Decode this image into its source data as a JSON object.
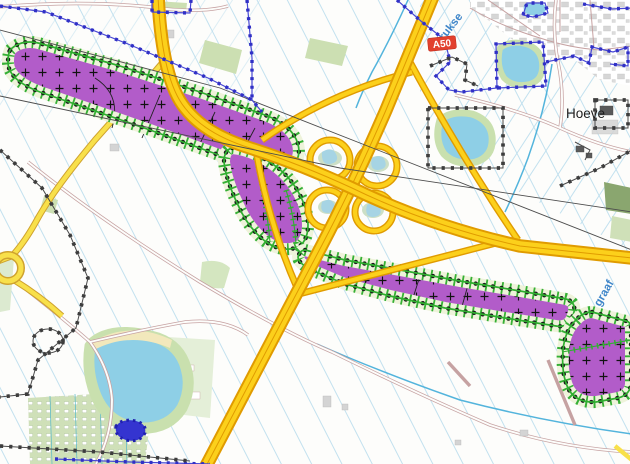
{
  "map": {
    "title": "zoning-map-a50-interchange",
    "labels": {
      "road_shield": "A50",
      "watercourse_nw": "Krukse",
      "place_ne": "Hoeve",
      "watercourse_se": "graaf"
    },
    "zones": {
      "nw_strip": "planning-zone-nw-strip",
      "sw_hook": "planning-zone-sw-hook",
      "se_strip": "planning-zone-se-strip",
      "far_se_parcel": "planning-zone-far-se-parcel"
    },
    "colors": {
      "zone_fill_purple": "#b25cc9",
      "zone_border_green": "#2fae2f",
      "zone_band_cream": "#eef3da",
      "zone_outline_dots": "#1a1a1a",
      "motorway_fill": "#fcd01b",
      "motorway_casing": "#e09b00",
      "secondary_road_fill": "#f8e04a",
      "local_road_casing": "#c6a2a2",
      "water_fill": "#8ecfe6",
      "water_line": "#53b4dc",
      "boundary_blue": "#3030c6",
      "boundary_dark": "#3d3d3d",
      "parcel_line_blue": "#bcdeee",
      "field_green": "#ccdfb2",
      "shield_red": "#e2402e",
      "shield_text": "#ffffff"
    }
  }
}
